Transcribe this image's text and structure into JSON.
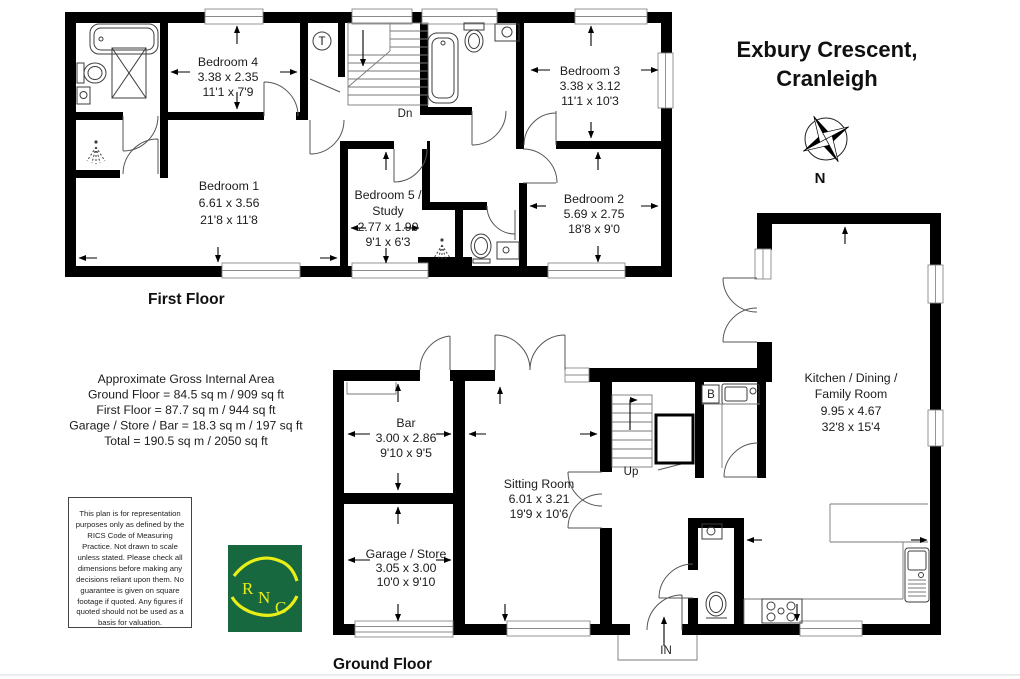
{
  "title": {
    "line1": "Exbury Crescent,",
    "line2": "Cranleigh"
  },
  "compass": {
    "north_label": "N"
  },
  "first_floor": {
    "label": "First Floor",
    "stairs_label": "Dn",
    "tank_label": "T",
    "rooms": {
      "bedroom4": {
        "name": "Bedroom 4",
        "metric": "3.38 x 2.35",
        "imperial": "11'1 x 7'9"
      },
      "bedroom3": {
        "name": "Bedroom 3",
        "metric": "3.38 x 3.12",
        "imperial": "11'1 x 10'3"
      },
      "bedroom1": {
        "name": "Bedroom 1",
        "metric": "6.61 x 3.56",
        "imperial": "21'8 x 11'8"
      },
      "bedroom5": {
        "name_line1": "Bedroom 5 /",
        "name_line2": "Study",
        "metric": "2.77 x 1.90",
        "imperial": "9'1 x 6'3"
      },
      "bedroom2": {
        "name": "Bedroom 2",
        "metric": "5.69 x 2.75",
        "imperial": "18'8 x 9'0"
      }
    }
  },
  "ground_floor": {
    "label": "Ground Floor",
    "stairs_label": "Up",
    "boiler_label": "B",
    "entrance_label": "IN",
    "rooms": {
      "bar": {
        "name": "Bar",
        "metric": "3.00 x 2.86",
        "imperial": "9'10 x 9'5"
      },
      "garage": {
        "name": "Garage / Store",
        "metric": "3.05 x 3.00",
        "imperial": "10'0 x 9'10"
      },
      "sitting_room": {
        "name": "Sitting Room",
        "metric": "6.01 x 3.21",
        "imperial": "19'9 x 10'6"
      },
      "kitchen": {
        "name_line1": "Kitchen / Dining /",
        "name_line2": "Family Room",
        "metric": "9.95 x 4.67",
        "imperial": "32'8 x 15'4"
      }
    }
  },
  "area_summary": {
    "heading": "Approximate Gross Internal Area",
    "ground_floor": "Ground Floor = 84.5 sq m / 909 sq ft",
    "first_floor": "First Floor = 87.7 sq m / 944 sq ft",
    "garage_store_bar": "Garage / Store / Bar = 18.3 sq m / 197 sq ft",
    "total": "Total = 190.5 sq m / 2050 sq ft"
  },
  "disclaimer": {
    "text": "This plan is for representation purposes only as defined by the RICS Code of Measuring Practice. Not drawn to scale unless stated. Please check all dimensions before making any decisions reliant upon them. No guarantee is given on square footage if quoted. Any figures if quoted should not be used as a basis for valuation."
  },
  "logo": {
    "letter1": "R",
    "letter2": "N",
    "letter3": "C"
  },
  "colors": {
    "wall": "#000000",
    "logo_green": "#17673f",
    "logo_yellow": "#e9ee18"
  }
}
